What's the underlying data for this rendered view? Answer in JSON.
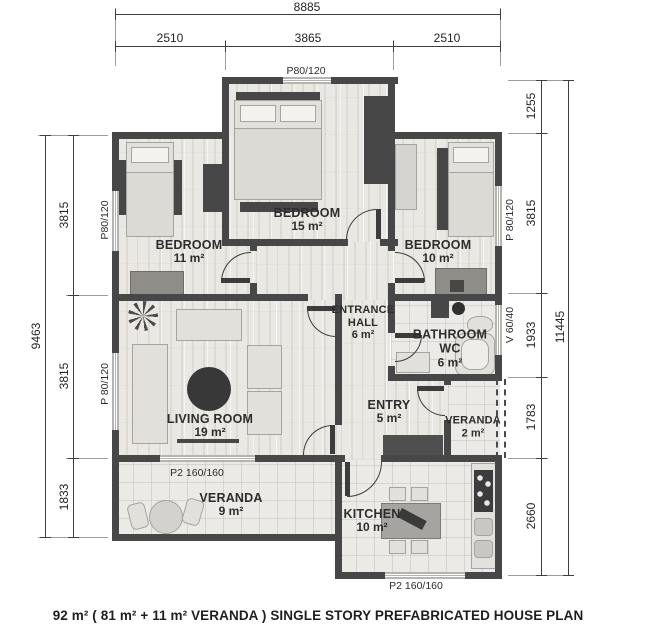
{
  "caption": "92 m²  ( 81 m² + 11 m²  VERANDA ) SINGLE STORY PREFABRICATED HOUSE PLAN",
  "rooms": {
    "bedroom_top": {
      "name": "BEDROOM",
      "area": "15 m²"
    },
    "bedroom_left": {
      "name": "BEDROOM",
      "area": "11 m²"
    },
    "bedroom_right": {
      "name": "BEDROOM",
      "area": "10 m²"
    },
    "entrance_hall": {
      "name": "ENTRANCE HALL",
      "area": "6 m²"
    },
    "bathroom": {
      "name": "BATHROOM WC",
      "area": "6 m²"
    },
    "living_room": {
      "name": "LIVING ROOM",
      "area": "19 m²"
    },
    "entry": {
      "name": "ENTRY",
      "area": "5 m²"
    },
    "veranda_small": {
      "name": "VERANDA",
      "area": "2 m²"
    },
    "veranda_large": {
      "name": "VERANDA",
      "area": "9 m²"
    },
    "kitchen": {
      "name": "KITCHEN",
      "area": "10 m²"
    }
  },
  "dimensions": {
    "top": {
      "total": "8885",
      "segments": [
        "2510",
        "3865",
        "2510"
      ]
    },
    "left": {
      "total": "9463",
      "segments": [
        "3815",
        "3815",
        "1833"
      ]
    },
    "right": {
      "total": "11445",
      "segments": [
        "1255",
        "3815",
        "1933",
        "1783",
        "2660"
      ]
    }
  },
  "openings": {
    "window_top": "P80/120",
    "window_left_bedroom": "P80/120",
    "window_left_living": "P 80/120",
    "window_right_bedroom": "P 80/120",
    "window_right_bathroom": "V 60/40",
    "door_living_veranda": "P2 160/160",
    "window_kitchen": "P2 160/160"
  },
  "colors": {
    "wall": "#474747",
    "floor_wood": "#eae8e3",
    "floor_tile": "#eceae7",
    "dim_line": "#3f3f3f",
    "text": "#2b2b2b"
  }
}
